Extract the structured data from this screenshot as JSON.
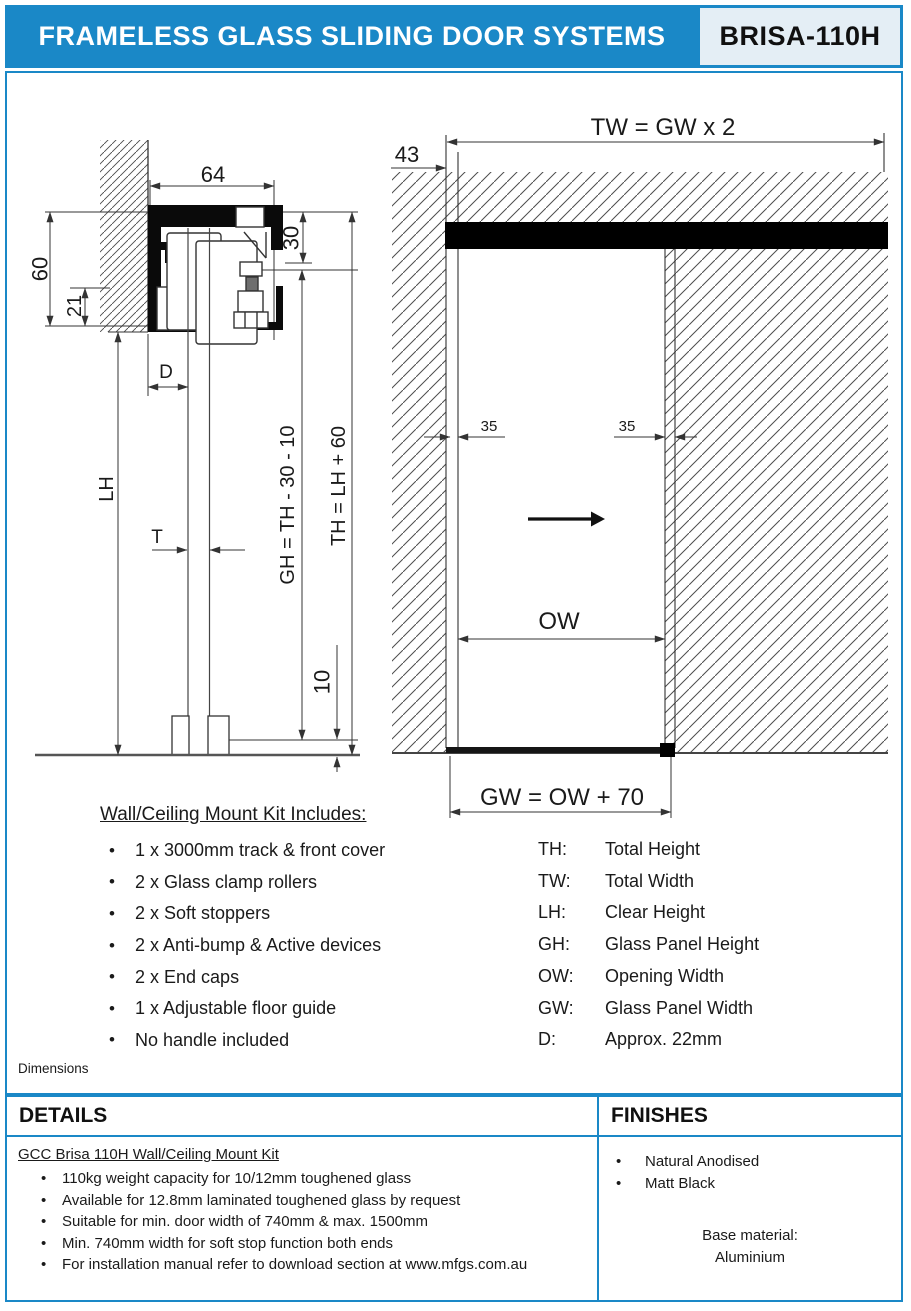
{
  "header": {
    "title": "FRAMELESS GLASS SLIDING DOOR SYSTEMS",
    "model": "BRISA-110H"
  },
  "colors": {
    "accent_blue": "#1a88c7",
    "model_box_bg": "#e4eef5",
    "track_black": "#000000"
  },
  "drawing": {
    "section": {
      "dim_64": "64",
      "dim_30": "30",
      "dim_60": "60",
      "dim_21": "21",
      "dim_d": "D",
      "dim_lh": "LH",
      "dim_t": "T",
      "dim_gh": "GH = TH - 30 - 10",
      "dim_th": "TH = LH + 60",
      "dim_10": "10"
    },
    "elevation": {
      "dim_tw": "TW = GW x 2",
      "dim_43": "43",
      "dim_35_left": "35",
      "dim_35_right": "35",
      "dim_ow": "OW",
      "dim_gw": "GW = OW + 70"
    }
  },
  "kit": {
    "heading": "Wall/Ceiling Mount Kit Includes:",
    "bullet": "•",
    "items": [
      "1 x 3000mm track & front cover",
      "2 x Glass clamp rollers",
      "2 x Soft stoppers",
      "2 x Anti-bump & Active devices",
      "2 x End caps",
      "1 x Adjustable floor guide",
      "No handle included"
    ]
  },
  "abbreviations": [
    {
      "key": "TH:",
      "value": "Total Height"
    },
    {
      "key": "TW:",
      "value": "Total Width"
    },
    {
      "key": "LH:",
      "value": "Clear Height"
    },
    {
      "key": "GH:",
      "value": "Glass Panel Height"
    },
    {
      "key": "OW:",
      "value": "Opening Width"
    },
    {
      "key": "GW:",
      "value": "Glass Panel Width"
    },
    {
      "key": "D:",
      "value": "Approx. 22mm"
    }
  ],
  "dimensions_label": "Dimensions",
  "details": {
    "heading": "DETAILS",
    "subheading": "GCC Brisa 110H Wall/Ceiling Mount Kit",
    "bullet": "•",
    "items": [
      "110kg weight capacity for 10/12mm toughened glass",
      "Available for 12.8mm laminated toughened glass by request",
      "Suitable for min. door width of 740mm & max. 1500mm",
      "Min. 740mm width for soft stop function both ends",
      "For installation manual refer to download section at www.mfgs.com.au"
    ]
  },
  "finishes": {
    "heading": "FINISHES",
    "bullet": "•",
    "items": [
      "Natural Anodised",
      "Matt Black"
    ],
    "base_material_label": "Base material:",
    "base_material_value": "Aluminium"
  }
}
